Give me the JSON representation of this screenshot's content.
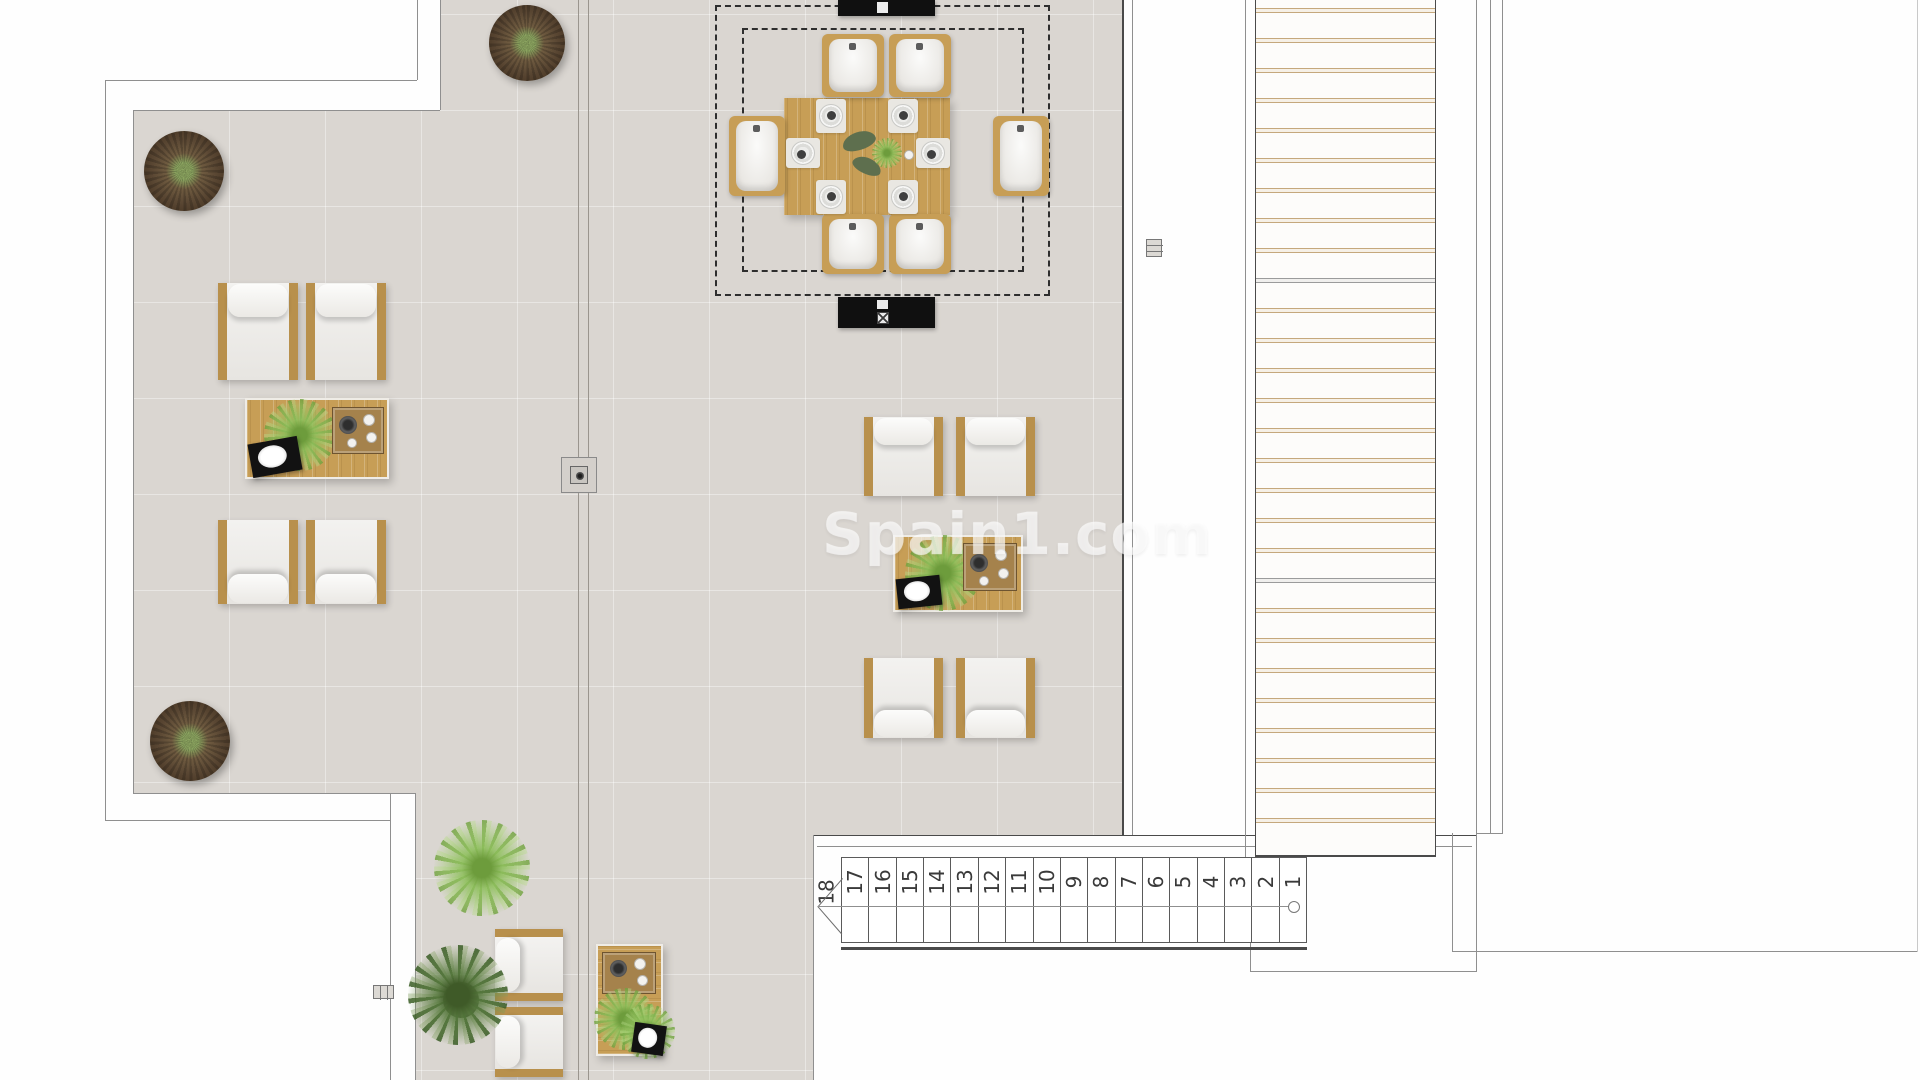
{
  "watermark": {
    "text": "Spain1.com"
  },
  "staircase": {
    "steps": [
      "18",
      "17",
      "16",
      "15",
      "14",
      "13",
      "12",
      "11",
      "10",
      "9",
      "8",
      "7",
      "6",
      "5",
      "4",
      "3",
      "2",
      "1"
    ],
    "step_count": 18
  },
  "deck": {
    "slat_count": 28,
    "gray_slat_indices": [
      9,
      19
    ]
  },
  "colors": {
    "floor_tile": "#dad6d1",
    "wood": "#c79e56",
    "chair_frame_wood": "#b8904c",
    "cushion_white": "#f2f1ee",
    "plant_green": "#6f9c3f",
    "tree_brown": "#55422e",
    "deck_slat_tan": "#c5a87c",
    "black_unit": "#101010",
    "wall_line_gray": "#8f8f8f",
    "watermark_white": "rgba(255,255,255,0.55)"
  }
}
